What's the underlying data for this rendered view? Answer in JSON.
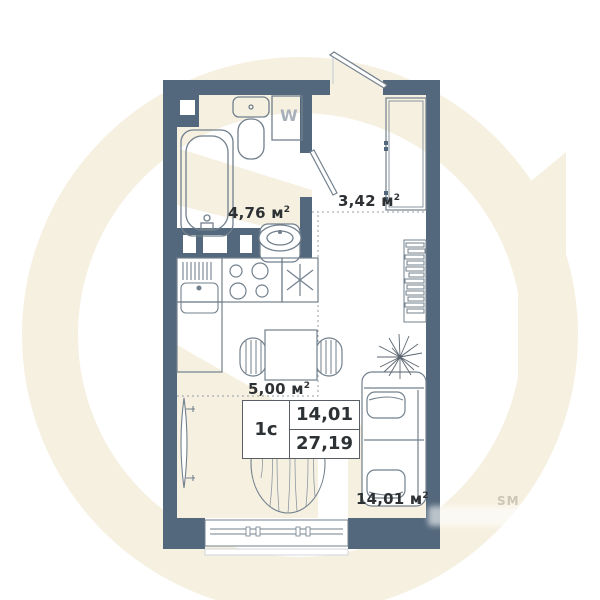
{
  "plan": {
    "unit_card": {
      "type": "1с",
      "area_living": "14,01",
      "area_total": "27,19"
    },
    "areas": {
      "bathroom": {
        "value": "4,76",
        "unit": "м"
      },
      "hall": {
        "value": "3,42",
        "unit": "м"
      },
      "kitchen": {
        "value": "5,00",
        "unit": "м"
      },
      "living": {
        "value": "14,01",
        "unit": "м"
      }
    },
    "sup": "2",
    "washer_label": "W"
  },
  "watermark": {
    "sm_label": "SM"
  },
  "colors": {
    "wall": "#53687c",
    "fixture_line": "#72808d",
    "label_text": "#2d3134",
    "watermark_beige": "#f6f0e1",
    "washer_text": "#a8b0ba"
  },
  "fixtures": [
    "bathtub",
    "toilet",
    "washing-machine",
    "wash-basin",
    "kitchen-sink",
    "stove",
    "fridge",
    "dining-table",
    "chair",
    "tv",
    "bookshelf",
    "plant",
    "sofa-bed",
    "rug",
    "window",
    "entrance-door",
    "bathroom-door",
    "wardrobe"
  ]
}
